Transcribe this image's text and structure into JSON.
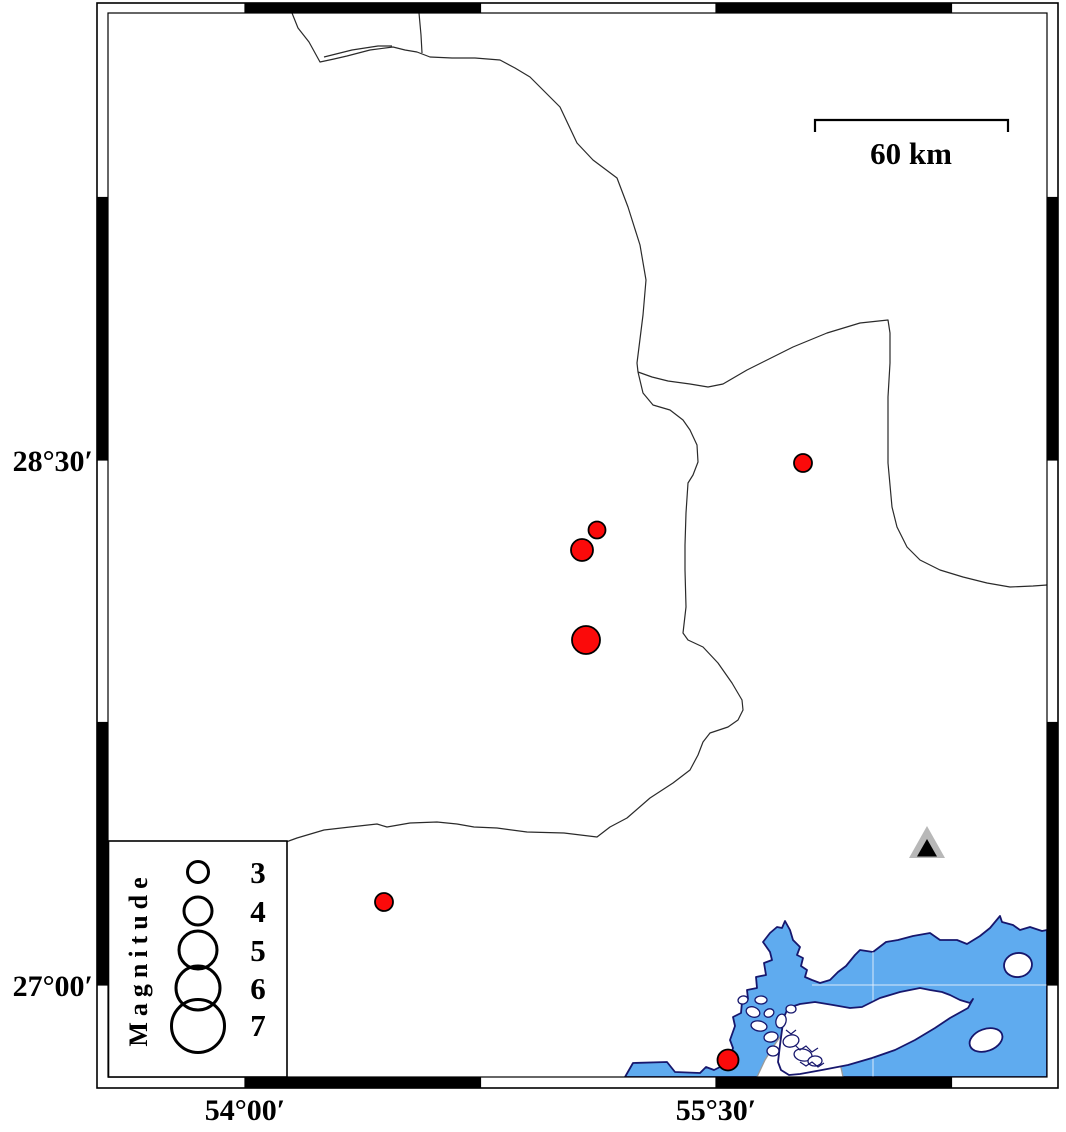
{
  "figure": {
    "kind": "earthquake-epicenter-map",
    "scale_bar": {
      "label": "60 km"
    },
    "axis": {
      "left": [
        {
          "text": "28°30′"
        },
        {
          "text": "27°00′"
        }
      ],
      "bottom": [
        {
          "text": "54°00′"
        },
        {
          "text": "55°30′"
        }
      ]
    },
    "legend": {
      "title": "Magnitude",
      "entries": [
        {
          "label": "3",
          "r": 10.5
        },
        {
          "label": "4",
          "r": 14
        },
        {
          "label": "5",
          "r": 19
        },
        {
          "label": "6",
          "r": 22
        },
        {
          "label": "7",
          "r": 26.5
        }
      ]
    }
  },
  "colors": {
    "water": "#5fabef",
    "coast": "#17176d",
    "coast_secondary": "#9a9a9a",
    "boundary_line": "#2a2a2a",
    "quake_fill": "#fb0a0a",
    "quake_stroke": "#000000",
    "triangle_gray": "#b8b8b8",
    "triangle_black": "#000000",
    "frame": "#000000",
    "grid_in_water": "#e8f0fb"
  },
  "map_data": {
    "frame": {
      "outer": [
        97,
        3,
        1058,
        1088
      ],
      "inner": [
        108,
        13,
        1047,
        1077
      ],
      "lon_ticks": [
        245,
        480.5,
        716,
        951.5
      ],
      "lat_ticks": [
        197.5,
        460,
        722.5,
        985
      ],
      "black_lon_segments": [
        [
          245,
          480.5
        ],
        [
          716,
          951.5
        ]
      ],
      "black_lat_segments": [
        [
          197.5,
          460
        ],
        [
          722.5,
          985
        ]
      ]
    },
    "earthquakes": [
      {
        "x": 597,
        "y": 530,
        "r": 8.5
      },
      {
        "x": 582,
        "y": 550,
        "r": 11
      },
      {
        "x": 586,
        "y": 640,
        "r": 14
      },
      {
        "x": 803,
        "y": 463,
        "r": 9
      },
      {
        "x": 384,
        "y": 902,
        "r": 9
      },
      {
        "x": 728,
        "y": 1060,
        "r": 10.5
      }
    ],
    "station": {
      "x": 927,
      "y": 843
    },
    "boundary_lines": [
      [
        [
          292,
          13
        ],
        [
          298,
          28
        ],
        [
          309,
          42
        ],
        [
          320,
          62
        ],
        [
          334,
          59
        ],
        [
          347,
          56
        ],
        [
          370,
          50
        ],
        [
          393,
          47
        ],
        [
          405,
          50
        ],
        [
          417,
          52
        ],
        [
          430,
          57
        ],
        [
          452,
          58
        ],
        [
          475,
          58
        ],
        [
          500,
          60
        ],
        [
          515,
          68
        ],
        [
          530,
          77
        ],
        [
          545,
          92
        ],
        [
          560,
          107
        ],
        [
          577,
          143
        ],
        [
          593,
          160
        ],
        [
          617,
          178
        ],
        [
          628,
          207
        ],
        [
          640,
          245
        ],
        [
          646,
          280
        ],
        [
          643,
          315
        ],
        [
          637,
          363
        ],
        [
          638,
          372
        ]
      ],
      [
        [
          324,
          57
        ],
        [
          352,
          50
        ],
        [
          378,
          46
        ],
        [
          392,
          46
        ]
      ],
      [
        [
          419,
          13
        ],
        [
          421,
          35
        ],
        [
          422,
          53
        ]
      ],
      [
        [
          638,
          372
        ],
        [
          652,
          377
        ],
        [
          668,
          381
        ],
        [
          690,
          384
        ],
        [
          708,
          387
        ],
        [
          723,
          384
        ],
        [
          747,
          370
        ],
        [
          773,
          357
        ],
        [
          793,
          347
        ],
        [
          827,
          333
        ],
        [
          860,
          323
        ],
        [
          888,
          320
        ],
        [
          890,
          333
        ],
        [
          890,
          363
        ],
        [
          888,
          397
        ],
        [
          888,
          430
        ],
        [
          888,
          463
        ],
        [
          892,
          507
        ],
        [
          897,
          527
        ],
        [
          907,
          547
        ],
        [
          920,
          560
        ],
        [
          940,
          570
        ],
        [
          963,
          577
        ],
        [
          987,
          583
        ],
        [
          1010,
          587
        ],
        [
          1033,
          586
        ],
        [
          1047,
          585
        ]
      ],
      [
        [
          638,
          372
        ],
        [
          643,
          393
        ],
        [
          653,
          405
        ],
        [
          670,
          410
        ],
        [
          683,
          420
        ],
        [
          690,
          430
        ],
        [
          697,
          445
        ],
        [
          698,
          462
        ],
        [
          693,
          475
        ],
        [
          688,
          483
        ],
        [
          686,
          513
        ],
        [
          685,
          545
        ],
        [
          685,
          570
        ],
        [
          686,
          607
        ],
        [
          683,
          633
        ],
        [
          688,
          640
        ],
        [
          703,
          647
        ],
        [
          718,
          663
        ],
        [
          732,
          683
        ],
        [
          742,
          700
        ],
        [
          743,
          710
        ],
        [
          738,
          720
        ],
        [
          728,
          727
        ],
        [
          710,
          733
        ],
        [
          703,
          742
        ],
        [
          698,
          755
        ],
        [
          690,
          770
        ],
        [
          673,
          783
        ],
        [
          650,
          798
        ],
        [
          627,
          818
        ],
        [
          610,
          827
        ],
        [
          597,
          837
        ],
        [
          564,
          833
        ],
        [
          527,
          832
        ],
        [
          497,
          828
        ],
        [
          474,
          827
        ],
        [
          457,
          824
        ],
        [
          437,
          822
        ],
        [
          410,
          823
        ],
        [
          387,
          827
        ],
        [
          377,
          824
        ],
        [
          350,
          827
        ],
        [
          324,
          830
        ],
        [
          297,
          838
        ],
        [
          286,
          842
        ]
      ]
    ],
    "water_polygon": [
      [
        625,
        1077
      ],
      [
        633,
        1063
      ],
      [
        667,
        1062
      ],
      [
        675,
        1072
      ],
      [
        700,
        1073
      ],
      [
        706,
        1067
      ],
      [
        714,
        1070
      ],
      [
        722,
        1066
      ],
      [
        730,
        1058
      ],
      [
        733,
        1048
      ],
      [
        730,
        1040
      ],
      [
        735,
        1026
      ],
      [
        733,
        1017
      ],
      [
        741,
        1013
      ],
      [
        742,
        1002
      ],
      [
        748,
        999
      ],
      [
        747,
        990
      ],
      [
        757,
        988
      ],
      [
        756,
        977
      ],
      [
        766,
        975
      ],
      [
        764,
        963
      ],
      [
        772,
        960
      ],
      [
        770,
        952
      ],
      [
        763,
        942
      ],
      [
        770,
        933
      ],
      [
        777,
        927
      ],
      [
        782,
        928
      ],
      [
        785,
        921
      ],
      [
        790,
        930
      ],
      [
        793,
        940
      ],
      [
        800,
        947
      ],
      [
        797,
        955
      ],
      [
        803,
        958
      ],
      [
        801,
        966
      ],
      [
        807,
        970
      ],
      [
        805,
        977
      ],
      [
        812,
        980
      ],
      [
        820,
        983
      ],
      [
        830,
        980
      ],
      [
        838,
        972
      ],
      [
        846,
        966
      ],
      [
        855,
        955
      ],
      [
        860,
        950
      ],
      [
        873,
        952
      ],
      [
        886,
        942
      ],
      [
        898,
        940
      ],
      [
        913,
        936
      ],
      [
        930,
        933
      ],
      [
        940,
        940
      ],
      [
        957,
        940
      ],
      [
        967,
        944
      ],
      [
        980,
        936
      ],
      [
        990,
        928
      ],
      [
        1000,
        916
      ],
      [
        1002,
        922
      ],
      [
        1013,
        925
      ],
      [
        1020,
        930
      ],
      [
        1030,
        927
      ],
      [
        1042,
        931
      ],
      [
        1047,
        930
      ],
      [
        1047,
        1077
      ]
    ],
    "island_polygon": [
      [
        788,
        1008
      ],
      [
        800,
        1004
      ],
      [
        815,
        1002
      ],
      [
        833,
        1005
      ],
      [
        850,
        1008
      ],
      [
        862,
        1007
      ],
      [
        880,
        998
      ],
      [
        900,
        992
      ],
      [
        920,
        988
      ],
      [
        930,
        990
      ],
      [
        942,
        992
      ],
      [
        950,
        995
      ],
      [
        960,
        1000
      ],
      [
        970,
        1003
      ],
      [
        973,
        999
      ],
      [
        968,
        1008
      ],
      [
        950,
        1018
      ],
      [
        935,
        1028
      ],
      [
        915,
        1040
      ],
      [
        895,
        1050
      ],
      [
        872,
        1058
      ],
      [
        848,
        1065
      ],
      [
        822,
        1070
      ],
      [
        800,
        1074
      ],
      [
        789,
        1075
      ],
      [
        781,
        1070
      ],
      [
        778,
        1062
      ],
      [
        780,
        1045
      ],
      [
        782,
        1030
      ],
      [
        784,
        1017
      ]
    ],
    "tidal_flat_polygon": [
      [
        757,
        1077
      ],
      [
        765,
        1060
      ],
      [
        773,
        1047
      ],
      [
        785,
        1030
      ],
      [
        800,
        1020
      ],
      [
        813,
        1023
      ],
      [
        827,
        1037
      ],
      [
        833,
        1050
      ],
      [
        840,
        1063
      ],
      [
        843,
        1077
      ]
    ],
    "marsh_islets": [
      {
        "cx": 743,
        "cy": 1000,
        "rx": 5,
        "ry": 4,
        "rot": -15
      },
      {
        "cx": 753,
        "cy": 1012,
        "rx": 7,
        "ry": 5,
        "rot": 20
      },
      {
        "cx": 761,
        "cy": 1000,
        "rx": 6,
        "ry": 4,
        "rot": 0
      },
      {
        "cx": 769,
        "cy": 1013,
        "rx": 5,
        "ry": 4,
        "rot": -25
      },
      {
        "cx": 759,
        "cy": 1026,
        "rx": 8,
        "ry": 5,
        "rot": 10
      },
      {
        "cx": 771,
        "cy": 1037,
        "rx": 7,
        "ry": 5,
        "rot": -10
      },
      {
        "cx": 781,
        "cy": 1021,
        "rx": 5,
        "ry": 7,
        "rot": 15
      },
      {
        "cx": 791,
        "cy": 1009,
        "rx": 5,
        "ry": 4,
        "rot": 0
      },
      {
        "cx": 791,
        "cy": 1041,
        "rx": 8,
        "ry": 6,
        "rot": -15
      },
      {
        "cx": 803,
        "cy": 1055,
        "rx": 9,
        "ry": 6,
        "rot": 10
      },
      {
        "cx": 815,
        "cy": 1061,
        "rx": 7,
        "ry": 5,
        "rot": -5
      },
      {
        "cx": 773,
        "cy": 1051,
        "rx": 6,
        "ry": 5,
        "rot": 0
      }
    ],
    "marsh_squiggles": [
      [
        [
          795,
          1045
        ],
        [
          800,
          1050
        ],
        [
          806,
          1046
        ],
        [
          812,
          1052
        ],
        [
          818,
          1048
        ]
      ],
      [
        [
          800,
          1062
        ],
        [
          806,
          1066
        ],
        [
          812,
          1062
        ],
        [
          818,
          1067
        ],
        [
          824,
          1063
        ]
      ],
      [
        [
          786,
          1030
        ],
        [
          791,
          1034
        ],
        [
          796,
          1030
        ]
      ]
    ],
    "small_islands": [
      {
        "cx": 1018,
        "cy": 965,
        "rx": 14,
        "ry": 12,
        "rot": -10
      },
      {
        "cx": 986,
        "cy": 1040,
        "rx": 17,
        "ry": 11,
        "rot": -20
      }
    ],
    "water_gridlines": {
      "vertical": {
        "x": 873,
        "y1": 952,
        "y2": 1077
      },
      "horizontal": {
        "y": 985,
        "x1": 812,
        "x2": 1047
      }
    }
  }
}
